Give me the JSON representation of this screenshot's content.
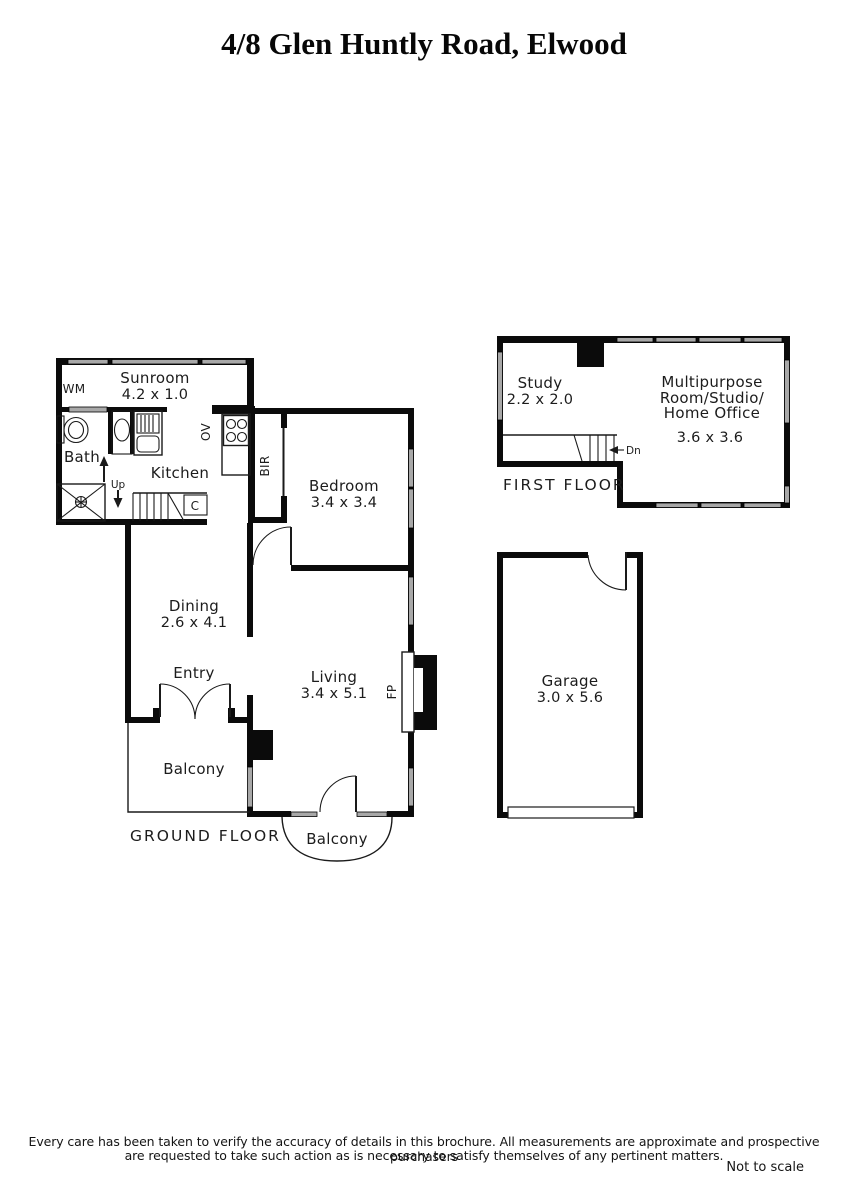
{
  "title": "4/8 Glen Huntly Road, Elwood",
  "ground_floor": {
    "floor_label": "GROUND FLOOR",
    "sunroom": {
      "name": "Sunroom",
      "dims": "4.2 x 1.0"
    },
    "bath": {
      "name": "Bath"
    },
    "kitchen": {
      "name": "Kitchen"
    },
    "bedroom": {
      "name": "Bedroom",
      "dims": "3.4 x 3.4"
    },
    "dining": {
      "name": "Dining",
      "dims": "2.6 x 4.1"
    },
    "entry": {
      "name": "Entry"
    },
    "living": {
      "name": "Living",
      "dims": "3.4 x 5.1"
    },
    "balcony_side": {
      "name": "Balcony"
    },
    "balcony_front": {
      "name": "Balcony"
    },
    "markers": {
      "wm": "WM",
      "ov": "OV",
      "bir": "BIR",
      "cupboard": "C",
      "up": "Up",
      "fp": "FP"
    }
  },
  "first_floor": {
    "floor_label": "FIRST FLOOR",
    "study": {
      "name": "Study",
      "dims": "2.2 x 2.0"
    },
    "multipurpose": {
      "line1": "Multipurpose",
      "line2": "Room/Studio/",
      "line3": "Home Office",
      "dims": "3.6 x 3.6"
    },
    "markers": {
      "dn": "Dn"
    }
  },
  "garage": {
    "name": "Garage",
    "dims": "3.0 x 5.6"
  },
  "colors": {
    "wall": "#0b0b0b",
    "window": "#a8a8a8",
    "background": "#ffffff"
  },
  "footer": {
    "line1": "Every care has been taken to verify the accuracy of details in this brochure.  All measurements are approximate and prospective purchasers",
    "line2": "are requested to take such action as is necessary to satisfy themselves of any pertinent matters.",
    "scale_note": "Not to scale"
  }
}
